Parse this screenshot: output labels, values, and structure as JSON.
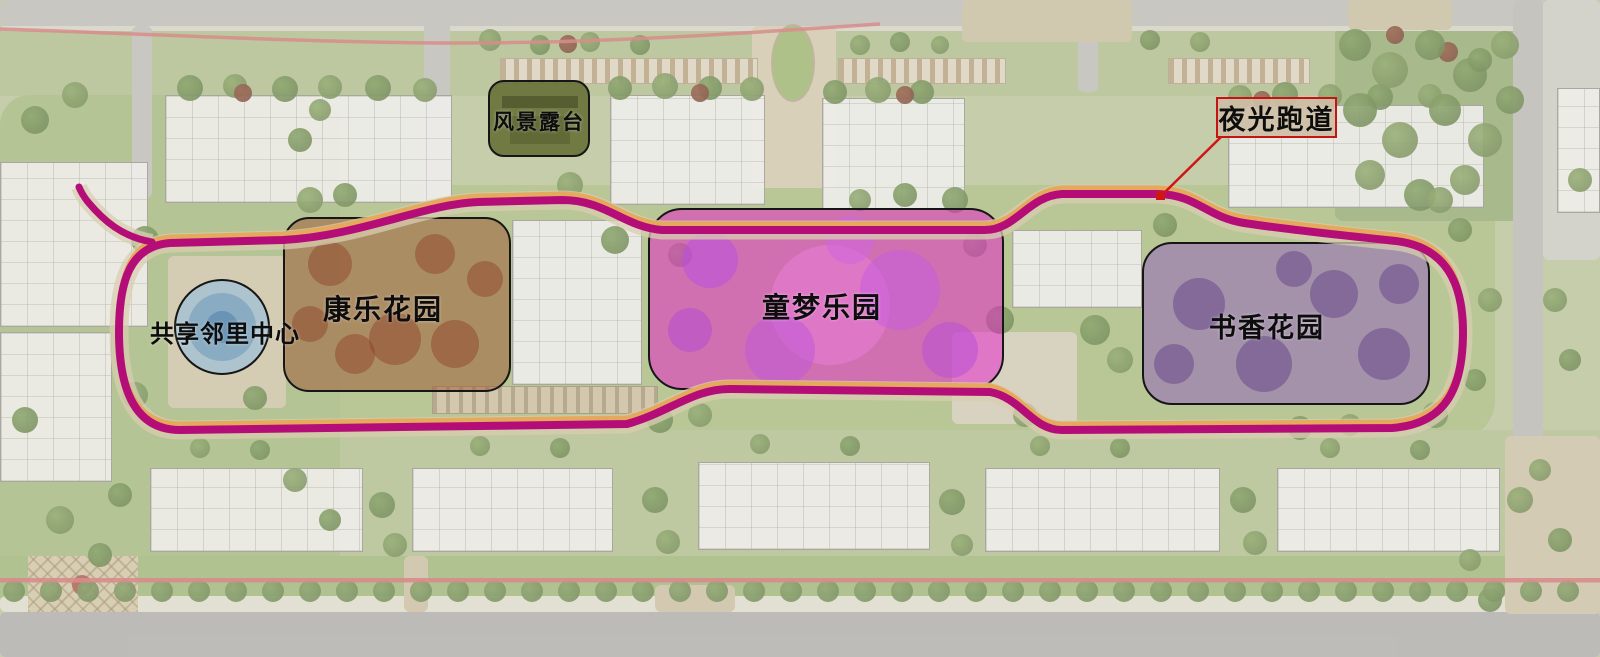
{
  "zones": [
    {
      "name": "scenic-terrace",
      "label": "风景露台",
      "fill": "rgba(97,107,48,0.85)",
      "border": "#161616"
    },
    {
      "name": "shared-neighborhood-center",
      "label": "共享邻里中心",
      "fill": "rgba(158,193,216,0.72)",
      "border": "#161616"
    },
    {
      "name": "kangle-garden",
      "label": "康乐花园",
      "fill": "rgba(160,94,60,0.55)",
      "border": "#161616"
    },
    {
      "name": "tongmeng-dreamland",
      "label": "童梦乐园",
      "fill": "rgba(232,26,203,0.50)",
      "border": "#161616"
    },
    {
      "name": "shuxiang-garden",
      "label": "书香花园",
      "fill": "rgba(148,106,184,0.58)",
      "border": "#161616"
    }
  ],
  "track": {
    "label": "夜光跑道",
    "track_color": "#b50d78",
    "edge_color": "#e5a95e",
    "path_color": "#d8cdb0",
    "marker_color": "#cf1616",
    "label_bg": "rgba(205,190,165,0.92)",
    "label_border": "#c41414"
  },
  "boundary": {
    "red_line_color": "#dd8181"
  }
}
